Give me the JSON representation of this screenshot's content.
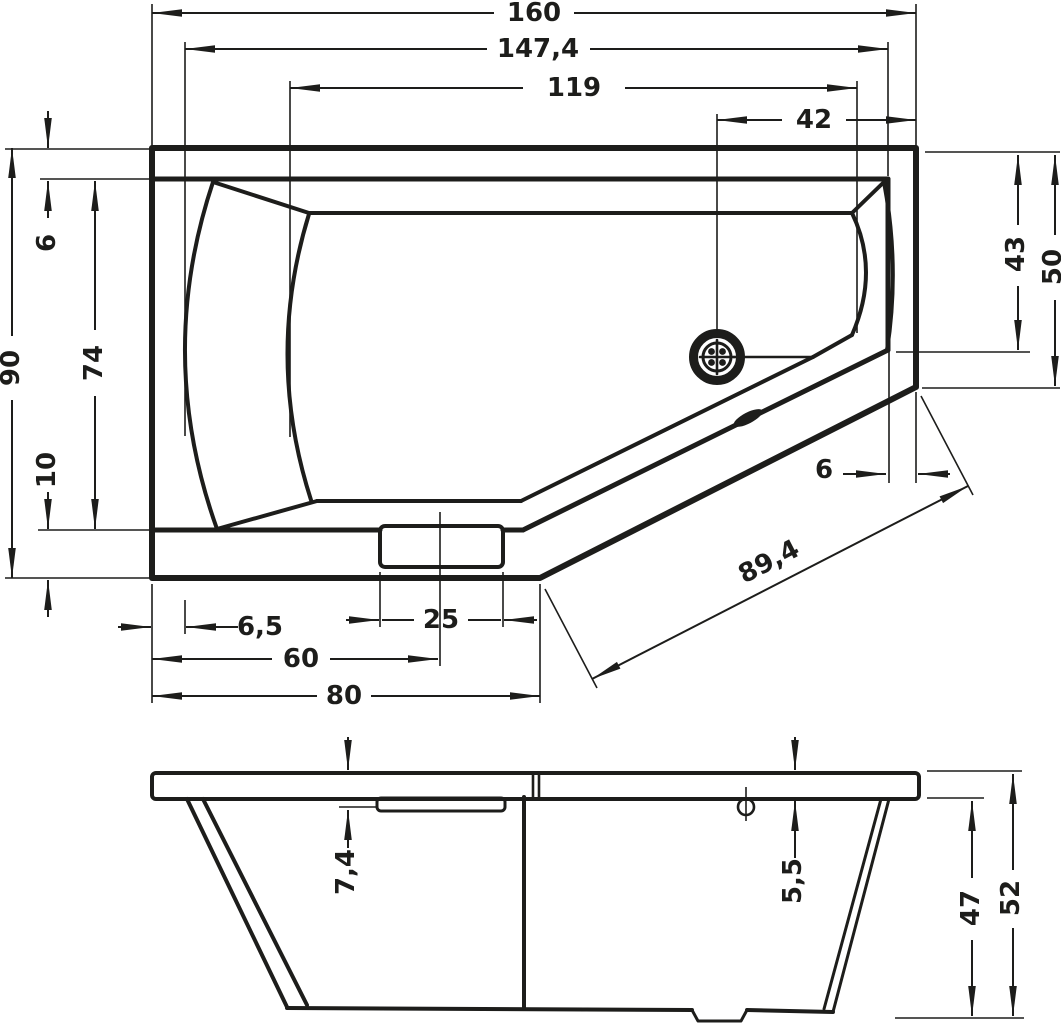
{
  "colors": {
    "line": "#1d1d1b",
    "background": "#ffffff"
  },
  "dimensions": {
    "plan": {
      "overall_width": "160",
      "rim_inner_width": "147,4",
      "basin_length": "119",
      "drain_offset_right": "42",
      "overall_depth": "90",
      "rim_top": "6",
      "rim_inner_depth": "74",
      "rim_bottom": "10",
      "rim_left": "6,5",
      "grip_center_from_left": "60",
      "grip_width": "25",
      "front_edge_length": "80",
      "diagonal_edge_length": "89,4",
      "diagonal_rim_width": "6",
      "right_corner_inner": "43",
      "right_edge_length": "50"
    },
    "section": {
      "grip_recess_depth": "7,4",
      "rim_thickness": "5,5",
      "body_height": "47",
      "overall_height": "52"
    }
  }
}
